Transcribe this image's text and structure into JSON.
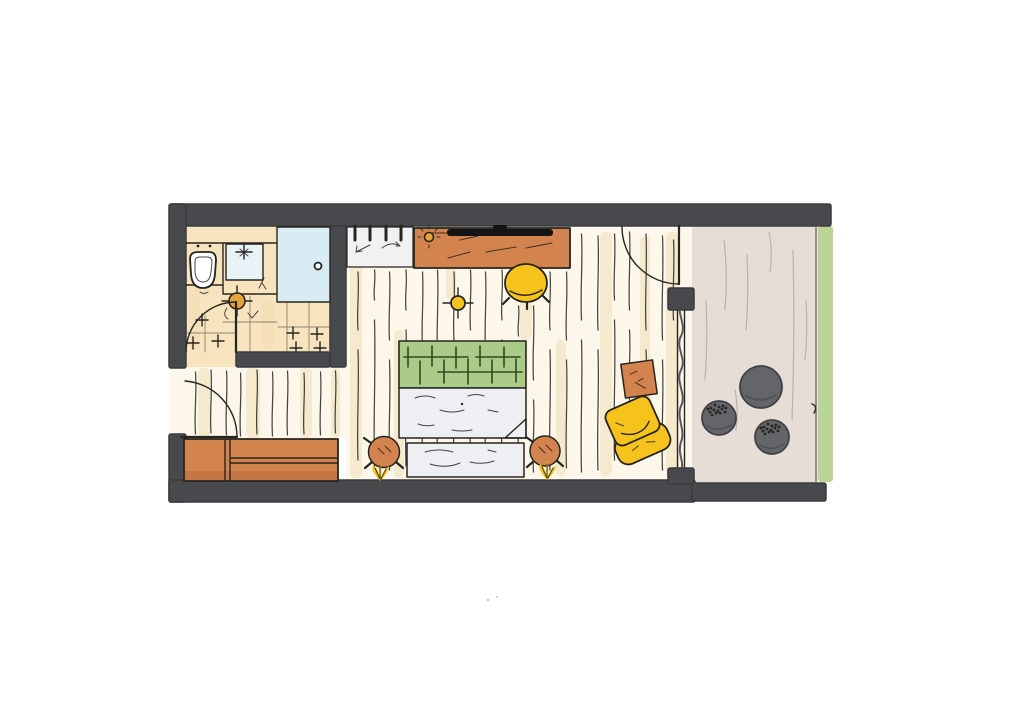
{
  "figure": {
    "kind": "hand-drawn marker floor plan",
    "subject": "studio hotel room with bathroom, entry hall, bedroom area and balcony",
    "visible_text": ""
  },
  "palette": {
    "background": "#ffffff",
    "wall": "#48494d",
    "ink": "#26251f",
    "wood": "#fcf7ea",
    "wood_streak": "#efd9ae",
    "plank_line": "#33312b",
    "bath_floor": "#f7e3bd",
    "shower": "#d9ecf4",
    "basin": "#e8f3f7",
    "white_fixture": "#ffffff",
    "orange": "#d2834e",
    "orange_dark": "#b96a39",
    "orange_accent": "#e5a33b",
    "yellow": "#f6c31c",
    "green_headboard": "#a9cb87",
    "headboard_line": "#30491f",
    "bedding": "#edeff2",
    "radiator": "#f1f1f4",
    "tv": "#141414",
    "balcony_floor": "#e7ddd7",
    "balcony_streak": "#b7a79e",
    "pouf": "#646569",
    "pouf_dark": "#3f4043",
    "grass": "#b9d495",
    "curtain": "#46474c"
  },
  "inventory": {
    "bathroom": [
      "toilet",
      "washbasin-counter",
      "shower",
      "ceiling-light",
      "tiled-floor",
      "bathroom-door"
    ],
    "entry_hall": [
      "entry-door",
      "wardrobe-sideboard",
      "wood-plank-floor"
    ],
    "bedroom": [
      "radiator",
      "desk-sideboard",
      "wall-tv",
      "desk-lamp",
      "desk-chair",
      "ceiling-light",
      "double-bed",
      "green-headboard",
      "duvet-with-folded-corner",
      "foot-bench",
      "bedside-stool-left",
      "bedside-stool-right",
      "wall-sconce-left",
      "wall-sconce-right",
      "side-table",
      "lounge-armchair",
      "curtain",
      "balcony-door",
      "glazed-window-wall"
    ],
    "balcony": [
      "stone-floor",
      "pouf-large",
      "pouf-dotted-near",
      "pouf-dotted-far",
      "grass-edge"
    ]
  }
}
